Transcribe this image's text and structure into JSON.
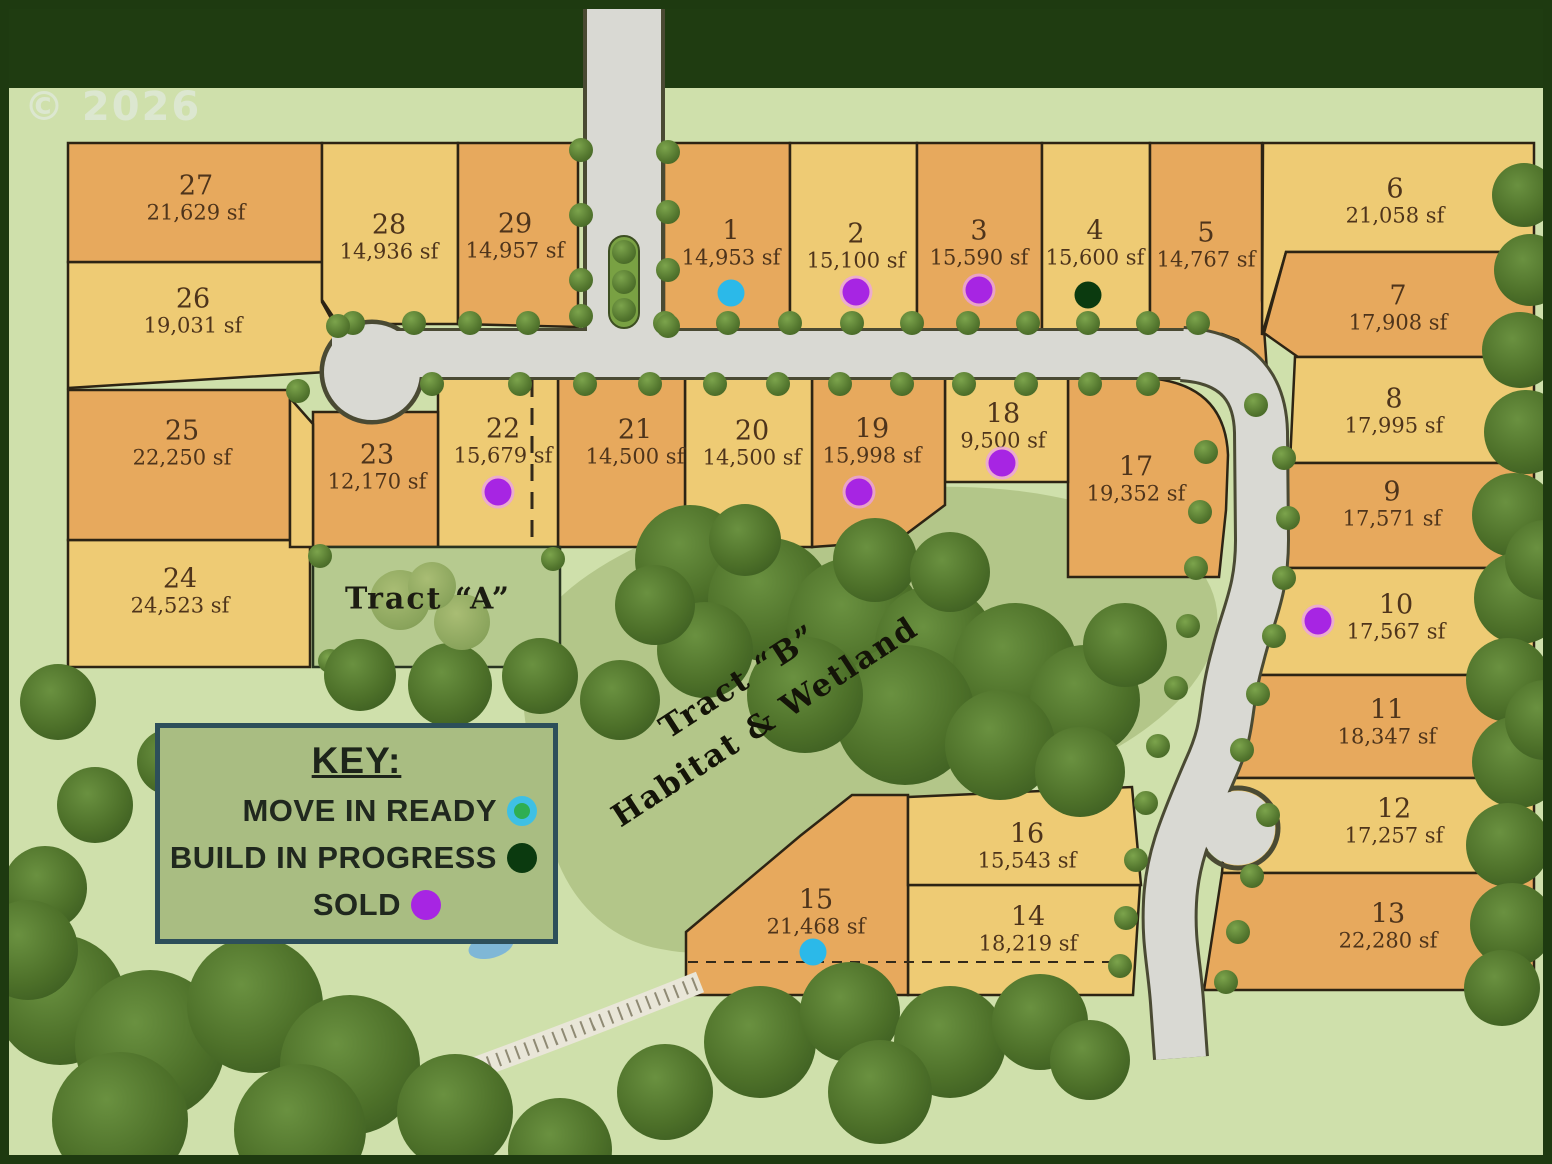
{
  "watermark": "© 2026",
  "map": {
    "tract_a_label": "Tract “A”",
    "tract_b_line1": "Tract “B”",
    "tract_b_line2": "Habitat  & Wetland"
  },
  "key": {
    "title": "KEY:",
    "items": [
      {
        "label": "MOVE IN READY",
        "status": "move-in-ready",
        "dot_color": "#2fae52",
        "dot_ring": "#3fc0e4"
      },
      {
        "label": "BUILD IN PROGRESS",
        "status": "build-in-progress",
        "dot_color": "#0b3a0f",
        "dot_ring": null
      },
      {
        "label": "SOLD",
        "status": "sold",
        "dot_color": "#a725e3",
        "dot_ring": null
      }
    ]
  },
  "colors": {
    "lot_orange": "#e7a95d",
    "lot_yellow": "#eecb74",
    "lot_border": "#2d2414",
    "road": "#d9d9d3",
    "status": {
      "move-in-ready": "#2bb9e9",
      "build-in-progress": "#0b3a0f",
      "sold": "#a725e3"
    }
  },
  "lots": [
    {
      "number": "1",
      "sf": "14,953 sf",
      "status": "move-in-ready"
    },
    {
      "number": "2",
      "sf": "15,100 sf",
      "status": "sold"
    },
    {
      "number": "3",
      "sf": "15,590 sf",
      "status": "sold"
    },
    {
      "number": "4",
      "sf": "15,600 sf",
      "status": "build-in-progress"
    },
    {
      "number": "5",
      "sf": "14,767 sf",
      "status": null
    },
    {
      "number": "6",
      "sf": "21,058 sf",
      "status": null
    },
    {
      "number": "7",
      "sf": "17,908 sf",
      "status": null
    },
    {
      "number": "8",
      "sf": "17,995 sf",
      "status": null
    },
    {
      "number": "9",
      "sf": "17,571 sf",
      "status": null
    },
    {
      "number": "10",
      "sf": "17,567 sf",
      "status": "sold"
    },
    {
      "number": "11",
      "sf": "18,347 sf",
      "status": null
    },
    {
      "number": "12",
      "sf": "17,257 sf",
      "status": null
    },
    {
      "number": "13",
      "sf": "22,280 sf",
      "status": null
    },
    {
      "number": "14",
      "sf": "18,219 sf",
      "status": null
    },
    {
      "number": "15",
      "sf": "21,468 sf",
      "status": "move-in-ready"
    },
    {
      "number": "16",
      "sf": "15,543 sf",
      "status": null
    },
    {
      "number": "17",
      "sf": "19,352 sf",
      "status": null
    },
    {
      "number": "18",
      "sf": "9,500 sf",
      "status": "sold"
    },
    {
      "number": "19",
      "sf": "15,998 sf",
      "status": "sold"
    },
    {
      "number": "20",
      "sf": "14,500 sf",
      "status": null
    },
    {
      "number": "21",
      "sf": "14,500 sf",
      "status": null
    },
    {
      "number": "22",
      "sf": "15,679 sf",
      "status": "sold"
    },
    {
      "number": "23",
      "sf": "12,170 sf",
      "status": null
    },
    {
      "number": "24",
      "sf": "24,523 sf",
      "status": null
    },
    {
      "number": "25",
      "sf": "22,250 sf",
      "status": null
    },
    {
      "number": "26",
      "sf": "19,031 sf",
      "status": null
    },
    {
      "number": "27",
      "sf": "21,629 sf",
      "status": null
    },
    {
      "number": "28",
      "sf": "14,936 sf",
      "status": null
    },
    {
      "number": "29",
      "sf": "14,957 sf",
      "status": null
    }
  ]
}
